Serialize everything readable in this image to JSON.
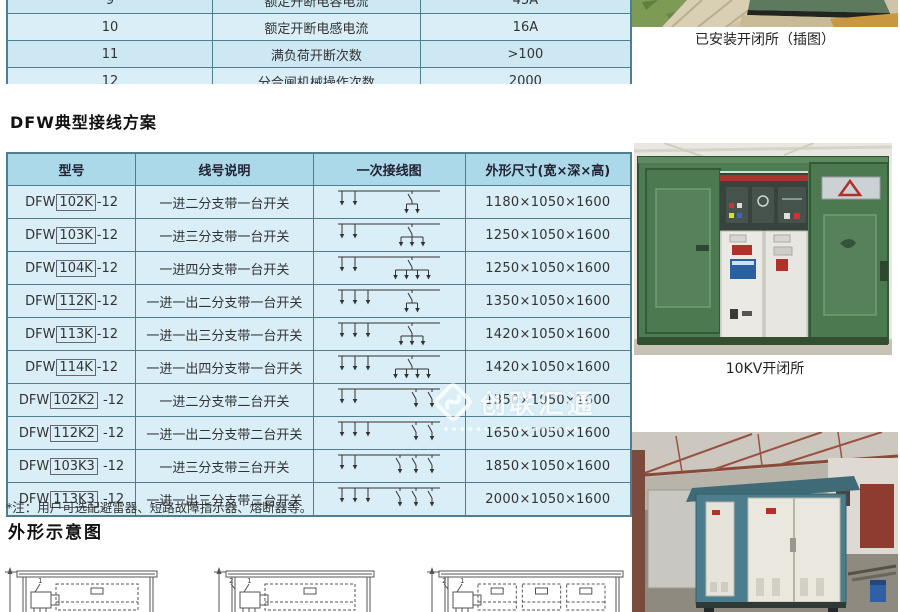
{
  "spec_table": {
    "rows": [
      {
        "no": "9",
        "param": "额定开断电容电流",
        "value": "45A"
      },
      {
        "no": "10",
        "param": "额定开断电感电流",
        "value": "16A"
      },
      {
        "no": "11",
        "param": "满负荷开断次数",
        "value": ">100"
      },
      {
        "no": "12",
        "param": "分合闸机械操作次数",
        "value": "2000"
      }
    ]
  },
  "wiring_section": {
    "title": "DFW典型接线方案",
    "table": {
      "headers": [
        "型号",
        "线号说明",
        "一次接线图",
        "外形尺寸(宽×深×高)"
      ],
      "rows": [
        {
          "model_prefix": "DFW",
          "model_box": "102K",
          "model_suffix": "-12",
          "desc": "一进二分支带一台开关",
          "dims": "1180×1050×1600",
          "diagram": {
            "inputs": 2,
            "switches": 1,
            "branches": 2
          }
        },
        {
          "model_prefix": "DFW",
          "model_box": "103K",
          "model_suffix": "-12",
          "desc": "一进三分支带一台开关",
          "dims": "1250×1050×1600",
          "diagram": {
            "inputs": 2,
            "switches": 1,
            "branches": 3
          }
        },
        {
          "model_prefix": "DFW",
          "model_box": "104K",
          "model_suffix": "-12",
          "desc": "一进四分支带一台开关",
          "dims": "1250×1050×1600",
          "diagram": {
            "inputs": 2,
            "switches": 1,
            "branches": 4
          }
        },
        {
          "model_prefix": "DFW",
          "model_box": "112K",
          "model_suffix": "-12",
          "desc": "一进一出二分支带一台开关",
          "dims": "1350×1050×1600",
          "diagram": {
            "inputs": 3,
            "switches": 1,
            "branches": 2
          }
        },
        {
          "model_prefix": "DFW",
          "model_box": "113K",
          "model_suffix": "-12",
          "desc": "一进一出三分支带一台开关",
          "dims": "1420×1050×1600",
          "diagram": {
            "inputs": 3,
            "switches": 1,
            "branches": 3
          }
        },
        {
          "model_prefix": "DFW",
          "model_box": "114K",
          "model_suffix": "-12",
          "desc": "一进一出四分支带一台开关",
          "dims": "1420×1050×1600",
          "diagram": {
            "inputs": 3,
            "switches": 1,
            "branches": 4
          }
        },
        {
          "model_prefix": "DFW",
          "model_box": "102K2",
          "model_suffix": " -12",
          "desc": "一进二分支带二台开关",
          "dims": "1350×1050×1600",
          "diagram": {
            "inputs": 2,
            "switches": 2,
            "branches": 0
          }
        },
        {
          "model_prefix": "DFW",
          "model_box": "112K2",
          "model_suffix": " -12",
          "desc": "一进一出二分支带二台开关",
          "dims": "1650×1050×1600",
          "diagram": {
            "inputs": 3,
            "switches": 2,
            "branches": 0
          }
        },
        {
          "model_prefix": "DFW",
          "model_box": "103K3",
          "model_suffix": " -12",
          "desc": "一进三分支带三台开关",
          "dims": "1850×1050×1600",
          "diagram": {
            "inputs": 2,
            "switches": 3,
            "branches": 0
          }
        },
        {
          "model_prefix": "DFW",
          "model_box": "113K3",
          "model_suffix": " -12",
          "desc": "一进一出三分支带三台开关",
          "dims": "2000×1050×1600",
          "diagram": {
            "inputs": 3,
            "switches": 3,
            "branches": 0
          }
        }
      ]
    },
    "note": "*注：用户可选配避雷器、短路故障指示器、熔断器等。"
  },
  "outline_section": {
    "title": "外形示意图",
    "drawings": [
      {
        "x": 4,
        "w": 157,
        "boxes": 1,
        "labels": [
          "1"
        ]
      },
      {
        "x": 213,
        "w": 165,
        "boxes": 1,
        "labels": [
          "2",
          "1"
        ]
      },
      {
        "x": 426,
        "w": 201,
        "boxes": 3,
        "labels": [
          "2",
          "1"
        ]
      }
    ]
  },
  "photos": [
    {
      "caption": "已安装开闭所（插图）"
    },
    {
      "caption": "10KV开闭所"
    }
  ],
  "watermark": {
    "text": "创联汇通"
  },
  "colors": {
    "table_header": "#abd9ea",
    "table_cell": "#d9eef7",
    "table_border": "#4f7e90",
    "cabinet_green": "#4e7b52",
    "substation_teal": "#4b7d8c"
  }
}
